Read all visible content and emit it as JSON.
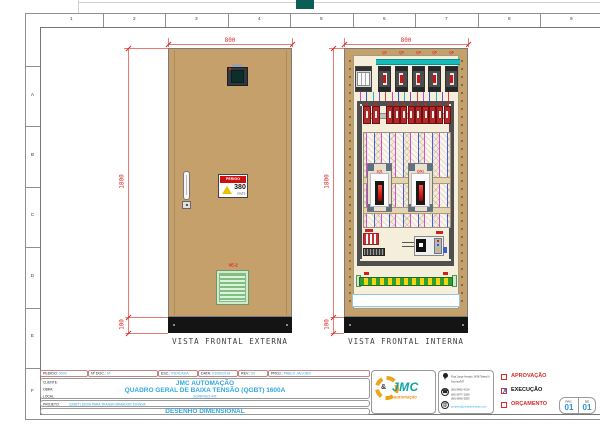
{
  "sheet": {
    "columns": [
      "1",
      "2",
      "3",
      "4",
      "5",
      "6",
      "7",
      "8",
      "9"
    ],
    "rows": [
      "A",
      "B",
      "C",
      "D",
      "E",
      "F"
    ]
  },
  "external_view": {
    "caption": "VISTA FRONTAL EXTERNA",
    "dims": {
      "width": "800",
      "height": "1800",
      "base": "100"
    },
    "danger_sticker": {
      "title": "PERIGO",
      "value": "380",
      "unit": "VOLTS"
    },
    "vent_label": "VE-2"
  },
  "internal_view": {
    "caption": "VISTA FRONTAL INTERNA",
    "dims": {
      "width": "800",
      "height": "1800",
      "base": "100"
    },
    "top_breaker_labels": [
      "Q2",
      "Q3",
      "Q4",
      "Q5",
      "Q6"
    ],
    "main_breaker_labels": [
      "1Q1",
      "QG1"
    ],
    "din_breaker_count": 11,
    "wire_colors": [
      "#cc44cc",
      "#3355dd",
      "#22b6b6",
      "#8a44cc",
      "#d04646"
    ]
  },
  "title_block": {
    "info_fields": [
      {
        "label": "PEDIDO:",
        "value": "9000"
      },
      {
        "label": "Nº DOC.:",
        "value": "Nº"
      },
      {
        "label": "ESC.:",
        "value": "INDICADA"
      },
      {
        "label": "DATA:",
        "value": "03/05/2018"
      },
      {
        "label": "REV.:",
        "value": "00"
      },
      {
        "label": "PROJ.:",
        "value": "PABLO JACOBS"
      }
    ],
    "cliente": {
      "label": "CLIENTE:",
      "value": "JMC AUTOMAÇÃO"
    },
    "obra": {
      "label": "OBRA:",
      "value": "QUADRO GERAL DE BAIXA TENSÃO (QGBT) 1600A"
    },
    "local": {
      "label": "LOCAL:",
      "value": "SORRISO-MT"
    },
    "projeto": {
      "label": "PROJETO:",
      "value": "(QGBT) 1600A PARA TRANSFORMADOR 1000kVA"
    },
    "drawing_title": "DESENHO DIMENSIONAL",
    "logo": {
      "amp": "&",
      "name": "JMC",
      "tagline": "automação"
    },
    "contact": {
      "address_line1": "Rua Jorge Amado 1438 Talard II",
      "address_line2": "Sorriso/MT",
      "phone1": "(66) 9992-4319",
      "phone2": "(66) 9977-1366",
      "phone3": "(66) 9690-3283",
      "email": "projetos@jmcautomacao.com",
      "phone_glyph": "☎",
      "mail_glyph": "@"
    },
    "approvals": [
      {
        "label": "APROVAÇÃO",
        "checked": false
      },
      {
        "label": "EXECUÇÃO",
        "checked": true
      },
      {
        "label": "ORÇAMENTO",
        "checked": false
      }
    ],
    "check_mark": "X",
    "page_box": {
      "pag_label": "PAG.",
      "pag_value": "01",
      "de_label": "DE",
      "de_value": "01"
    }
  }
}
